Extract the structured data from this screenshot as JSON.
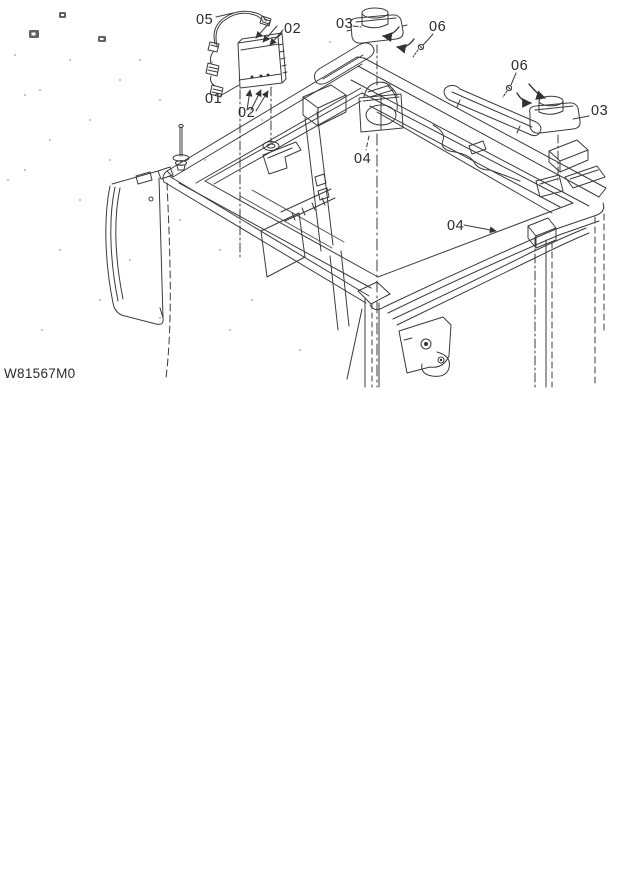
{
  "figure": {
    "drawing_code": "W81567M0",
    "callouts": {
      "harness": "05",
      "screws_top": "02",
      "cap_left": "03",
      "screw_left": "06",
      "controller": "01",
      "screws_bottom": "02",
      "screw_right": "06",
      "cap_right": "03",
      "housing_left": "04",
      "hole_right": "04"
    }
  }
}
